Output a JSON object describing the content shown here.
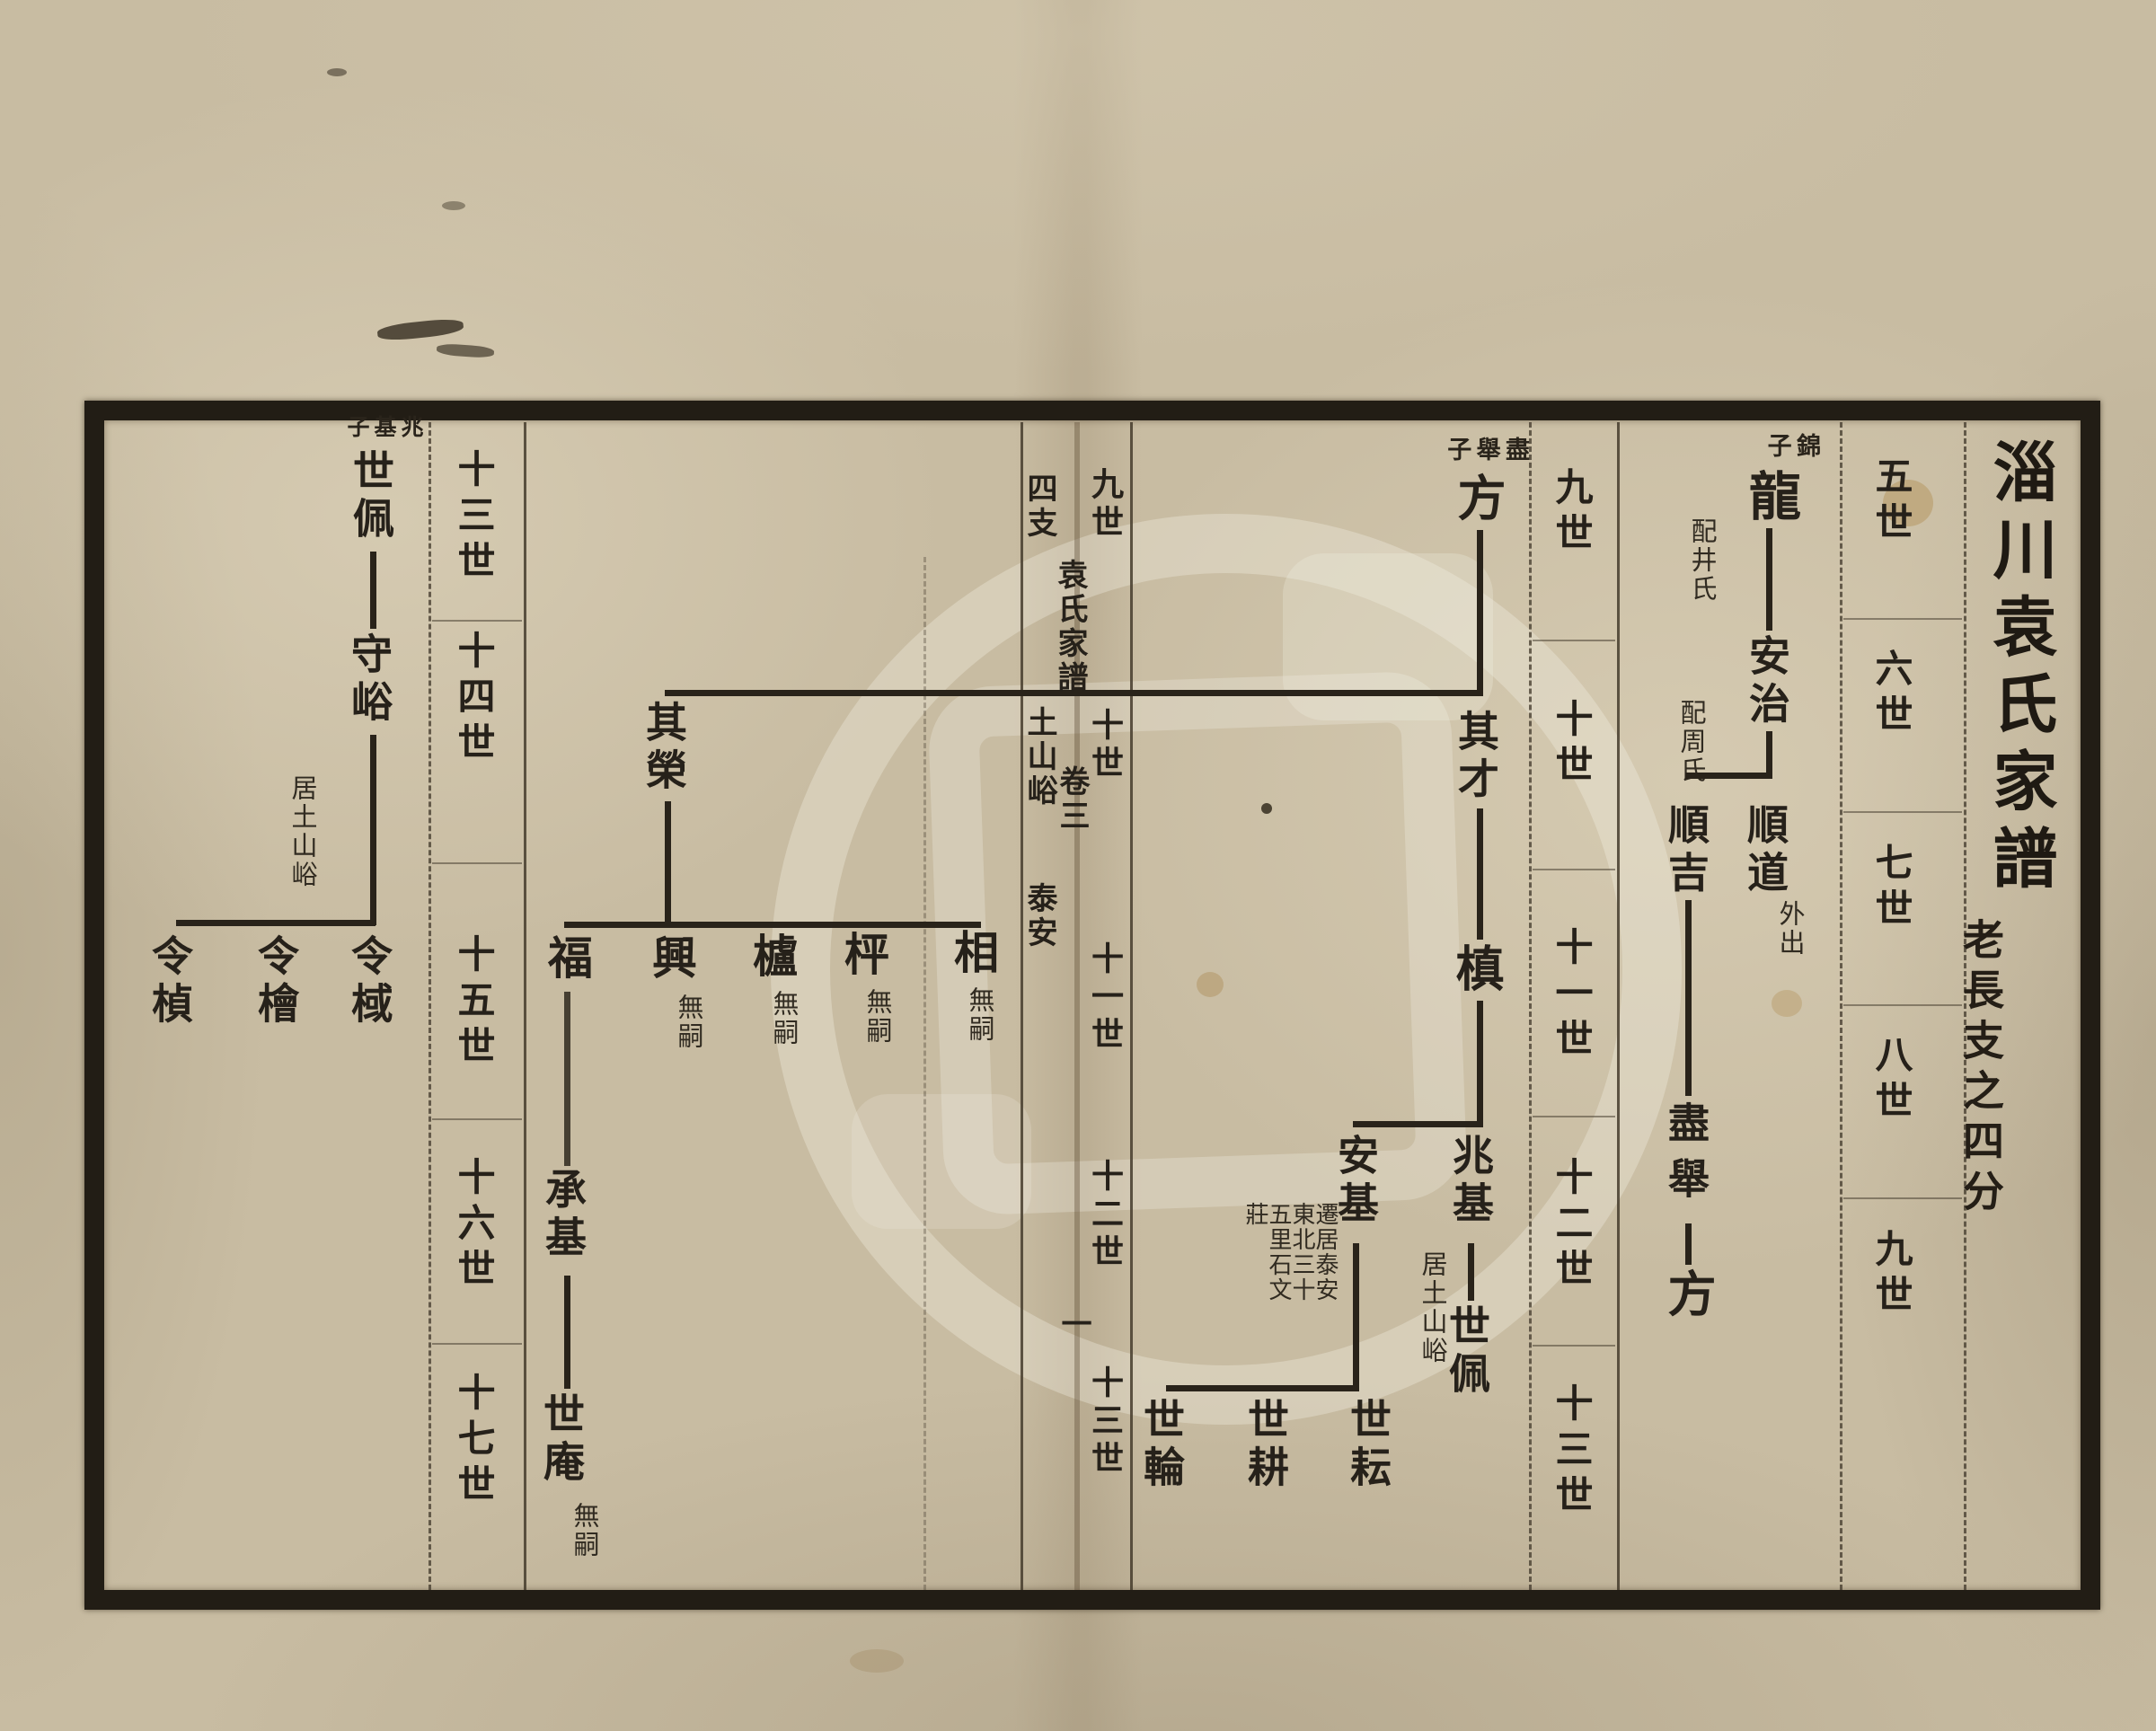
{
  "palette": {
    "paper": "#c8bca2",
    "ink": "#26211a",
    "frame": "#221d15"
  },
  "book": {
    "title": "淄川袁氏家譜",
    "subtitle": "老長支之四分",
    "fold_title": "袁氏家譜",
    "volume": "卷三",
    "folio": "一",
    "branch_label": "四支",
    "place_1": "土山峪",
    "place_2": "泰安"
  },
  "generation_columns": {
    "right_outer": [
      "五世",
      "六世",
      "七世",
      "八世",
      "九世"
    ],
    "right_inner": [
      "九世",
      "十世",
      "十一世",
      "十二世",
      "十三世"
    ],
    "fold": [
      "九世",
      "十世",
      "十一世",
      "十二世",
      "十三世"
    ],
    "left": [
      "十三世",
      "十四世",
      "十五世",
      "十六世",
      "十七世"
    ]
  },
  "tree_right_first": {
    "parent_label": "錦子",
    "gen5": "龍",
    "gen5_spouse": "配井氏",
    "gen6": "安治",
    "gen6_spouse": "配周氏",
    "gen7_right": "順道",
    "gen7_right_note": "外出",
    "gen7_left": "順吉",
    "gen8": "盡舉",
    "gen9": "方"
  },
  "tree_right_second": {
    "parent_label": "盡舉子",
    "gen9": "方",
    "gen10_right": "其才",
    "gen11": "槙",
    "gen12_right": "兆基",
    "gen12_right_note": "居土山峪",
    "gen12_left": "安基",
    "gen12_left_note": [
      "遷居泰安",
      "東北三十",
      "五里石文",
      "莊"
    ],
    "gen13_of_right": "世佩",
    "gen13_of_left": [
      "世耘",
      "世耕",
      "世輪"
    ]
  },
  "tree_left_page": {
    "gen10": "其榮",
    "gen11_sons": [
      "福",
      "興",
      "櫨",
      "枰",
      "相"
    ],
    "no_heir": "無嗣",
    "gen12": "承基",
    "gen13": "世庵"
  },
  "tree_left_far": {
    "parent_label": "兆基子",
    "gen13": "世佩",
    "gen14": "守峪",
    "gen14_note": "居土山峪",
    "gen15": [
      "令棫",
      "令檜",
      "令楨"
    ]
  }
}
